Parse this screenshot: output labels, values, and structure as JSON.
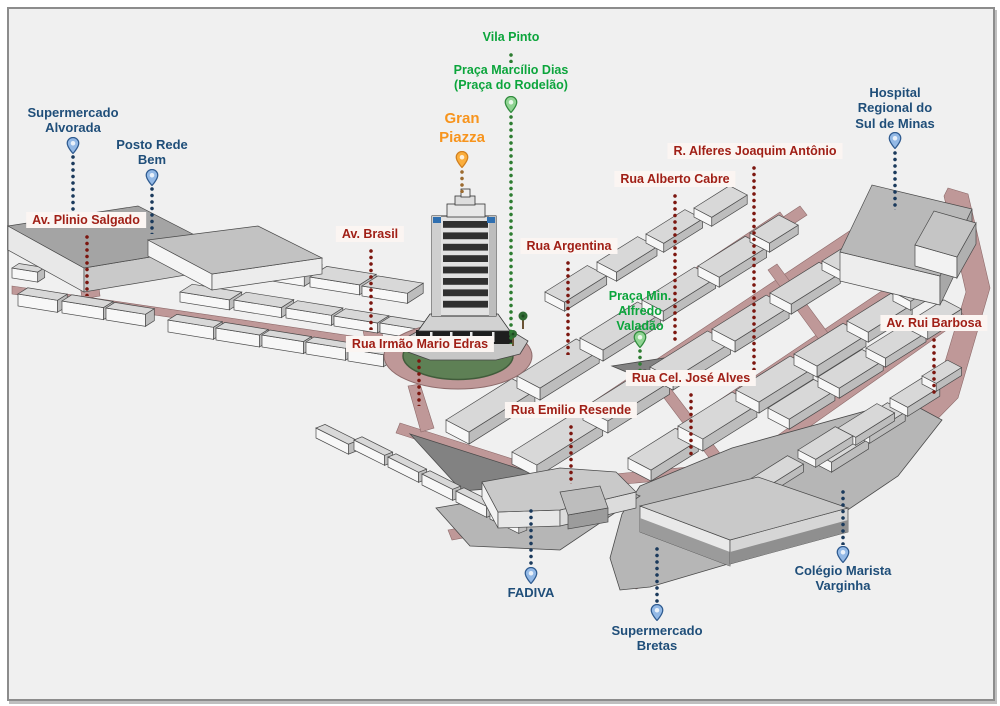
{
  "palette": {
    "canvas_bg": "#f0f0f0",
    "frame_border": "#8c8c8c",
    "street": "#bf9898",
    "street_edge": "#8d6a6a",
    "block_top": "#d8d8d8",
    "side_bright": "#f7f7f7",
    "side_shade": "#bdbdbd",
    "outline": "#4a4a4a",
    "plaza_dark": "#828282",
    "ground": "#b6b6b6",
    "green_circle": "#5e8055",
    "green_circle_edge": "#415c3b",
    "label_street_color": "#a01f16",
    "label_street_bg": "#fbf5f2",
    "label_place_color": "#1f4e79",
    "label_green_color": "#0ca53c",
    "label_orange_color": "#f7941d",
    "dots_red": "#7c1710",
    "dots_blue": "#1b3a5c",
    "dots_green": "#2e7d32",
    "dots_orange": "#9c6b30",
    "pin_blue": "#93b9e6",
    "pin_blue_stroke": "#2e5a8f",
    "pin_green": "#90d493",
    "pin_green_stroke": "#2f8a3c",
    "pin_orange": "#fbae3c",
    "pin_orange_stroke": "#d07f1f"
  },
  "markers": {
    "vila_pinto": {
      "label": "Vila Pinto"
    },
    "praca_marcilio": {
      "label": "Praça Marcílio Dias\n(Praça do Rodelão)"
    },
    "gran_piazza": {
      "label": "Gran\nPiazza"
    },
    "hospital": {
      "label": "Hospital\nRegional do\nSul de Minas"
    },
    "supermercado_alvorada": {
      "label": "Supermercado\nAlvorada"
    },
    "posto_rede_bem": {
      "label": "Posto Rede\nBem"
    },
    "av_plinio_salgado": {
      "label": "Av. Plinio Salgado"
    },
    "av_brasil": {
      "label": "Av. Brasil"
    },
    "rua_irmao_mario_edras": {
      "label": "Rua Irmão Mario Edras"
    },
    "rua_argentina": {
      "label": "Rua Argentina"
    },
    "rua_alberto_cabre": {
      "label": "Rua Alberto Cabre"
    },
    "r_alferes_joaquim_antonio": {
      "label": "R. Alferes Joaquim Antônio"
    },
    "praca_min_alfredo_valadao": {
      "label": "Praça Min.\nAlfredo\nValadão"
    },
    "av_rui_barbosa": {
      "label": "Av. Rui Barbosa"
    },
    "rua_cel_jose_alves": {
      "label": "Rua Cel. José Alves"
    },
    "rua_emilio_resende": {
      "label": "Rua Emilio Resende"
    },
    "fadiva": {
      "label": "FADIVA"
    },
    "supermercado_bretas": {
      "label": "Supermercado\nBretas"
    },
    "colegio_marista": {
      "label": "Colégio Marista\nVarginha"
    }
  }
}
